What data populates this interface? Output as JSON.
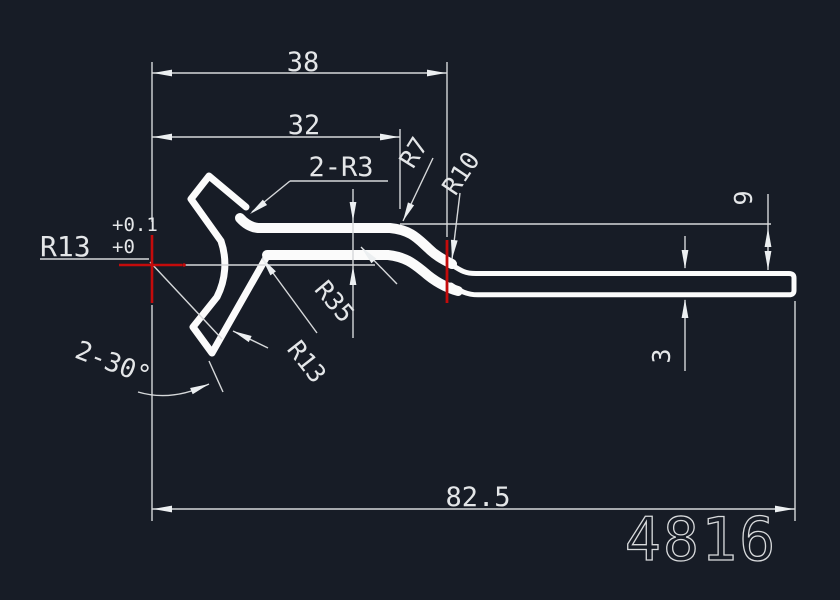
{
  "app": "cad-drawing-viewer",
  "part_number": "4816",
  "colors": {
    "background": "#171c26",
    "geometry": "#fbfbfb",
    "dimension_lines": "#d6d8da",
    "dimension_text": "#e4e6e8",
    "center_mark": "#c40b0b"
  },
  "dimensions": {
    "width_top": "38",
    "width_mid": "32",
    "length_total": "82.5",
    "height_step": "9",
    "bar_thickness": "3",
    "radius_tol_main": "R13",
    "radius_tol_upper": "+0.1",
    "radius_tol_lower": "+0",
    "fillets_top": "2-R3",
    "radius_r7": "R7",
    "radius_r10": "R10",
    "radius_r35": "R35",
    "radius_r13b": "R13",
    "angle_chamfer": "2-30°"
  },
  "annotations": {
    "part_label": "4816"
  }
}
